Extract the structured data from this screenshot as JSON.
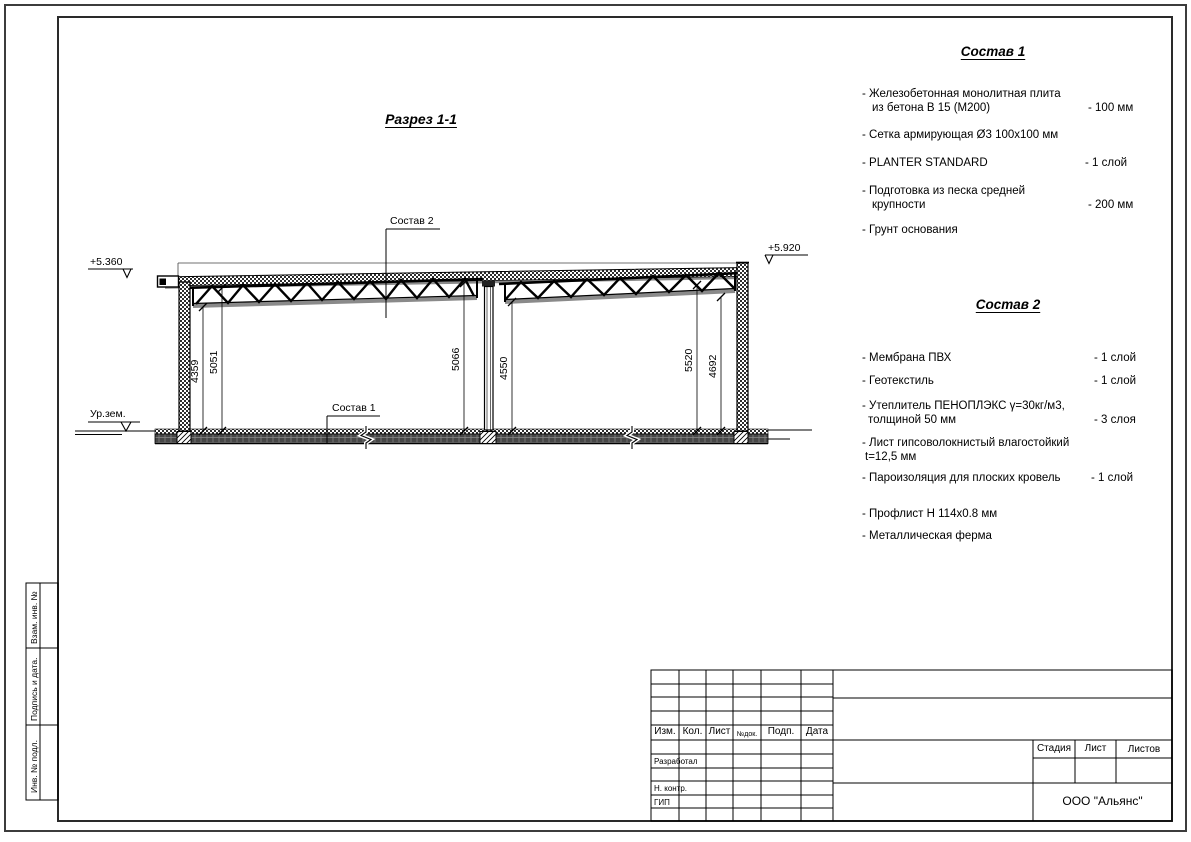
{
  "drawing": {
    "title": "Разрез 1-1",
    "elevation_left": "+5.360",
    "elevation_right": "+5.920",
    "ground_label": "Ур.зем.",
    "callout_sostav1": "Состав 1",
    "callout_sostav2": "Состав 2",
    "dimensions": [
      "4359",
      "5051",
      "5066",
      "4550",
      "5520",
      "4692"
    ]
  },
  "sostav1": {
    "title": "Состав 1",
    "items": [
      {
        "l1": "- Железобетонная  монолитная плита",
        "l2": "из бетона В 15 (М200)",
        "val": "- 100 мм"
      },
      {
        "l1": "- Сетка армирующая Ø3 100х100 мм"
      },
      {
        "l1": "- PLANTER STANDARD",
        "val": "- 1  слой"
      },
      {
        "l1": "- Подготовка из песка средней",
        "l2": "крупности",
        "val": "- 200 мм"
      },
      {
        "l1": "- Грунт основания"
      }
    ]
  },
  "sostav2": {
    "title": "Состав 2",
    "items": [
      {
        "l1": "- Мембрана ПВХ",
        "val": "- 1 слой"
      },
      {
        "l1": "- Геотекстиль",
        "val": "- 1 слой"
      },
      {
        "l1": "- Утеплитель ПЕНОПЛЭКС γ=30кг/м3,",
        "l2": "толщиной 50 мм",
        "val": "- 3 слоя"
      },
      {
        "l1": "- Лист гипсоволокнистый влагостойкий",
        "l2": "t=12,5 мм"
      },
      {
        "l1": "- Пароизоляция для плоских кровель",
        "val": "- 1 слой"
      },
      {
        "l1": "- Профлист Н 114х0.8 мм"
      },
      {
        "l1": "- Металлическая ферма"
      }
    ]
  },
  "titleblock": {
    "col_izm": "Изм.",
    "col_kol": "Кол.",
    "col_list": "Лист",
    "col_ndok": "№док.",
    "col_podp": "Подп.",
    "col_data": "Дата",
    "row_razrabotal": "Разработал",
    "row_nkontr": "Н. контр.",
    "row_gip": "ГИП",
    "stadia": "Стадия",
    "list": "Лист",
    "listov": "Листов",
    "company": "ООО \"Альянс\""
  },
  "margin_boxes": {
    "vzam": "Взам. инв. №",
    "podpis": "Подпись и дата.",
    "inv": "Инв. № подл."
  }
}
